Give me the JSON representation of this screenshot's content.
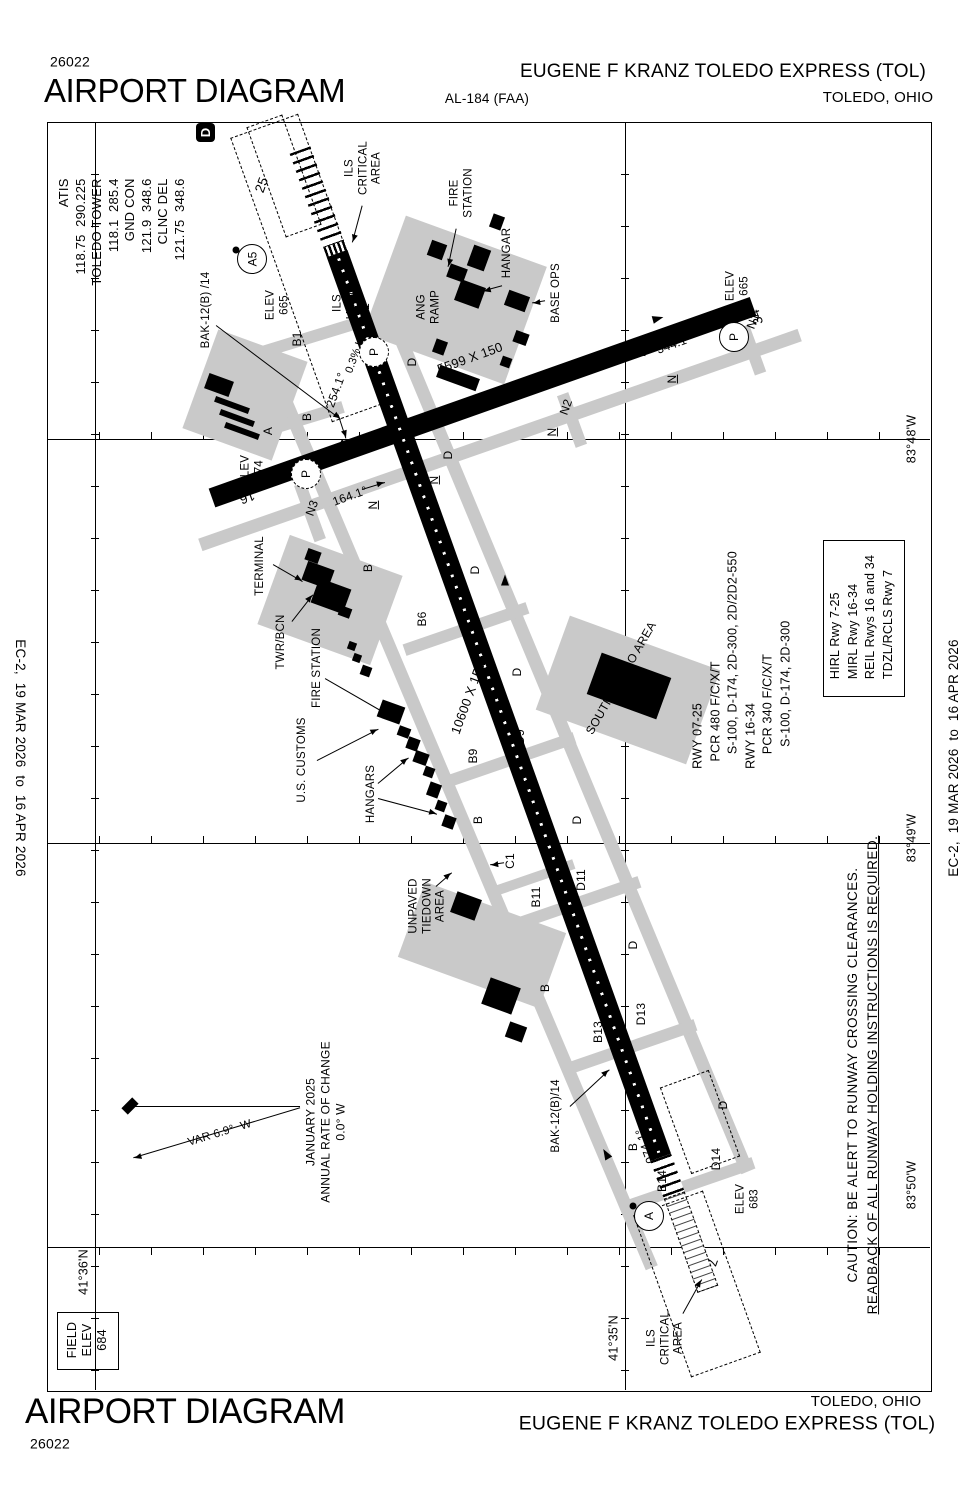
{
  "header": {
    "chart_number": "26022",
    "title": "AIRPORT DIAGRAM",
    "al_number": "AL-184 (FAA)",
    "airport_name": "EUGENE F KRANZ TOLEDO EXPRESS (TOL)",
    "city": "TOLEDO, OHIO"
  },
  "footer": {
    "chart_number": "26022",
    "title": "AIRPORT DIAGRAM",
    "airport_name": "EUGENE F KRANZ TOLEDO EXPRESS (TOL)",
    "city": "TOLEDO, OHIO"
  },
  "edge": {
    "effective": "EC-2,  19 MAR 2026  to  16 APR 2026"
  },
  "frequencies": "ATIS\n118.75  290.225\nTOLEDO TOWER\n118.1  285.4\nGND CON\n121.9  348.6\nCLNC DEL\n121.75  348.6",
  "hotspot_d": "D",
  "field_elev": "FIELD\nELEV\n684",
  "coords": {
    "lat1": "41°36'N",
    "lat2": "41°35'N",
    "lon1": "83°48'W",
    "lon2": "83°49'W",
    "lon3": "83°50'W"
  },
  "runway": {
    "rwy7": "7",
    "rwy25": "25",
    "rwy16": "16",
    "rwy34": "34",
    "dim_0725": "10600 X 150",
    "dim_1634": "5599 X 150",
    "hdg25": "254.1°",
    "hdg7": "074.1°",
    "hdg16": "164.1°",
    "hdg34": "344.1°",
    "grade": "0.3% UP",
    "elev_25": "ELEV\n665",
    "elev_16": "ELEV\n674",
    "elev_34": "ELEV\n665",
    "elev_7": "ELEV\n683"
  },
  "taxiway": {
    "a": "A",
    "a5": "A5",
    "b": "B",
    "b1": "B1",
    "b6": "B6",
    "b9": "B9",
    "b11": "B11",
    "b13": "B13",
    "b14": "B14",
    "c1": "C1",
    "d": "D",
    "d1": "D1",
    "d6": "D6",
    "d9": "D9",
    "d11": "D11",
    "d13": "D13",
    "d14": "D14",
    "n": "N",
    "n1": "N1",
    "n2": "N2",
    "n3": "N3",
    "p": "P",
    "a_circle": "A"
  },
  "facility": {
    "terminal": "TERMINAL",
    "twr_bcn": "TWR/BCN",
    "fire_station_top": "FIRE\nSTATION",
    "fire_station_mid": "FIRE STATION",
    "us_customs": "U.S. CUSTOMS",
    "hangars": "HANGARS",
    "hangar": "HANGAR",
    "base_ops": "BASE OPS",
    "ang_ramp": "ANG\nRAMP"
  },
  "area": {
    "ils_critical_top": "ILS\nCRITICAL\nAREA",
    "ils_critical_bottom": "ILS\nCRITICAL\nAREA",
    "ils_hold": "ILS\nHOLD",
    "south_cargo": "SOUTH CARGO AREA",
    "unpaved_tiedown": "UNPAVED\nTIEDOWN\nAREA"
  },
  "note": {
    "rwy_data": "RWY 07-25\n  PCR 480 F/C/X/T\n    S-100, D-174, 2D-300, 2D/2D2-550\nRWY 16-34\n    PCR 340 F/C/X/T\n      S-100, D-174, 2D-300",
    "lighting": "HIRL Rwy 7-25\nMIRL Rwy 16-34\nREIL Rwys 16 and 34\nTDZL/RCLS Rwy 7",
    "caution_line1": "CAUTION: BE ALERT TO RUNWAY CROSSING CLEARANCES.",
    "caution_line2": "READBACK OF ALL RUNWAY HOLDING INSTRUCTIONS IS REQUIRED.",
    "bak_top": "BAK-12(B) /14",
    "bak_bottom": "BAK-12(B)/14",
    "variation": "VAR 6.9°  W",
    "rate_of_change": "JANUARY 2025\nANNUAL RATE OF CHANGE\n0.0° W"
  }
}
